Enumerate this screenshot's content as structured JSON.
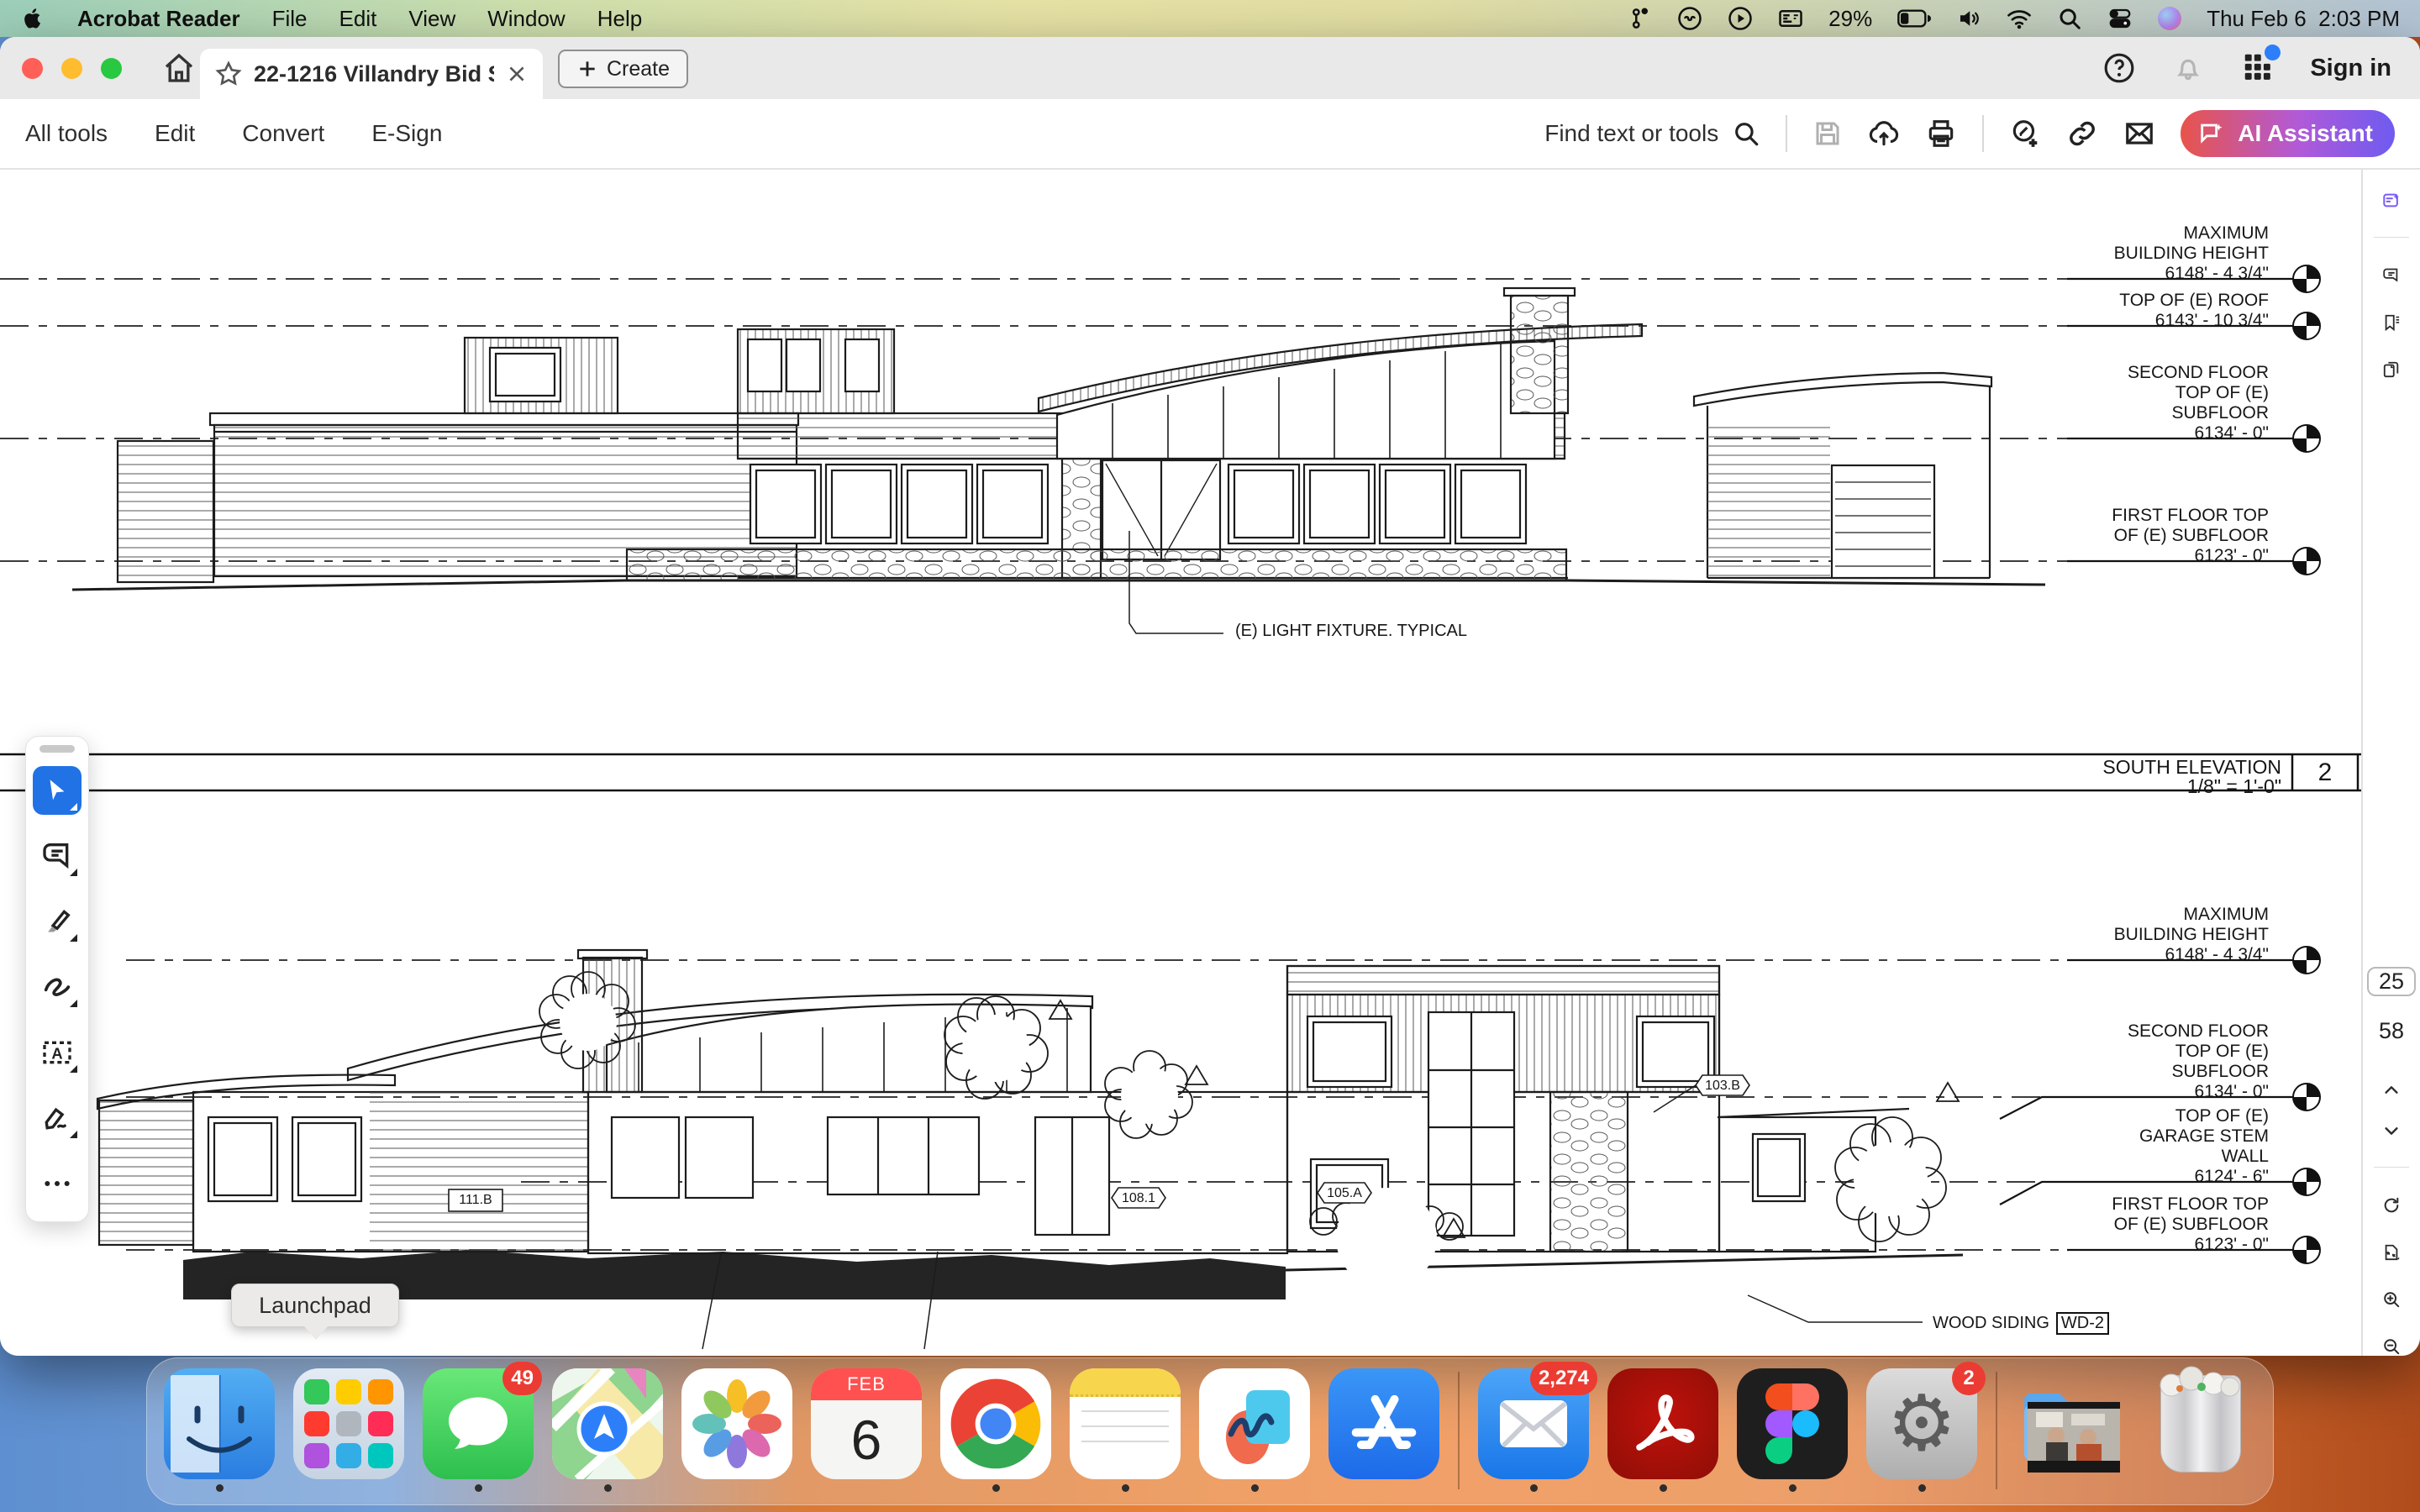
{
  "menubar": {
    "app_name": "Acrobat Reader",
    "menus": [
      "File",
      "Edit",
      "View",
      "Window",
      "Help"
    ],
    "battery": "29%",
    "clock": "Thu Feb 6  2:03 PM"
  },
  "tabbar": {
    "tab_title": "22-1216 Villandry Bid S...",
    "create": "Create",
    "sign_in": "Sign in"
  },
  "toolbar": {
    "menu_items": [
      "All tools",
      "Edit",
      "Convert",
      "E-Sign"
    ],
    "find": "Find text or tools",
    "ai_assistant": "AI Assistant",
    "ai_gradient_start": "#E8544A",
    "ai_gradient_end": "#6E5BF0"
  },
  "pdf": {
    "top": {
      "levels": [
        {
          "line1": "MAXIMUM",
          "line2": "BUILDING HEIGHT",
          "line3": "",
          "value": "6148' - 4 3/4\""
        },
        {
          "line1": "",
          "line2": "TOP OF (E) ROOF",
          "line3": "",
          "value": "6143' - 10 3/4\""
        },
        {
          "line1": "SECOND FLOOR",
          "line2": "TOP OF (E)",
          "line3": "SUBFLOOR",
          "value": "6134' - 0\""
        },
        {
          "line1": "FIRST FLOOR TOP",
          "line2": "OF (E) SUBFLOOR",
          "line3": "",
          "value": "6123' - 0\""
        }
      ],
      "light_note": "(E) LIGHT FIXTURE. TYPICAL"
    },
    "title_block": {
      "title": "SOUTH ELEVATION",
      "scale": "1/8\" = 1'-0\"",
      "number": "2"
    },
    "bottom": {
      "levels": [
        {
          "line1": "MAXIMUM",
          "line2": "BUILDING HEIGHT",
          "line3": "",
          "value": "6148' - 4 3/4\""
        },
        {
          "line1": "SECOND FLOOR",
          "line2": "TOP OF (E)",
          "line3": "SUBFLOOR",
          "value": "6134' - 0\""
        },
        {
          "line1": "TOP OF (E)",
          "line2": "GARAGE STEM",
          "line3": "WALL",
          "value": "6124' - 6\""
        },
        {
          "line1": "FIRST FLOOR TOP",
          "line2": "OF (E) SUBFLOOR",
          "line3": "",
          "value": "6123' - 0\""
        }
      ],
      "tags": {
        "t1": "111.B",
        "t2": "108.1",
        "t3": "105.A",
        "t4": "103.B"
      },
      "siding_note": "WOOD SIDING",
      "siding_tag": "WD-2"
    }
  },
  "page_nav": {
    "current": "25",
    "total": "58"
  },
  "tooltip": {
    "label": "Launchpad"
  },
  "dock": {
    "badges": {
      "messages": "49",
      "mail": "2,274",
      "settings": "2"
    },
    "calendar": {
      "month": "FEB",
      "day": "6"
    }
  }
}
